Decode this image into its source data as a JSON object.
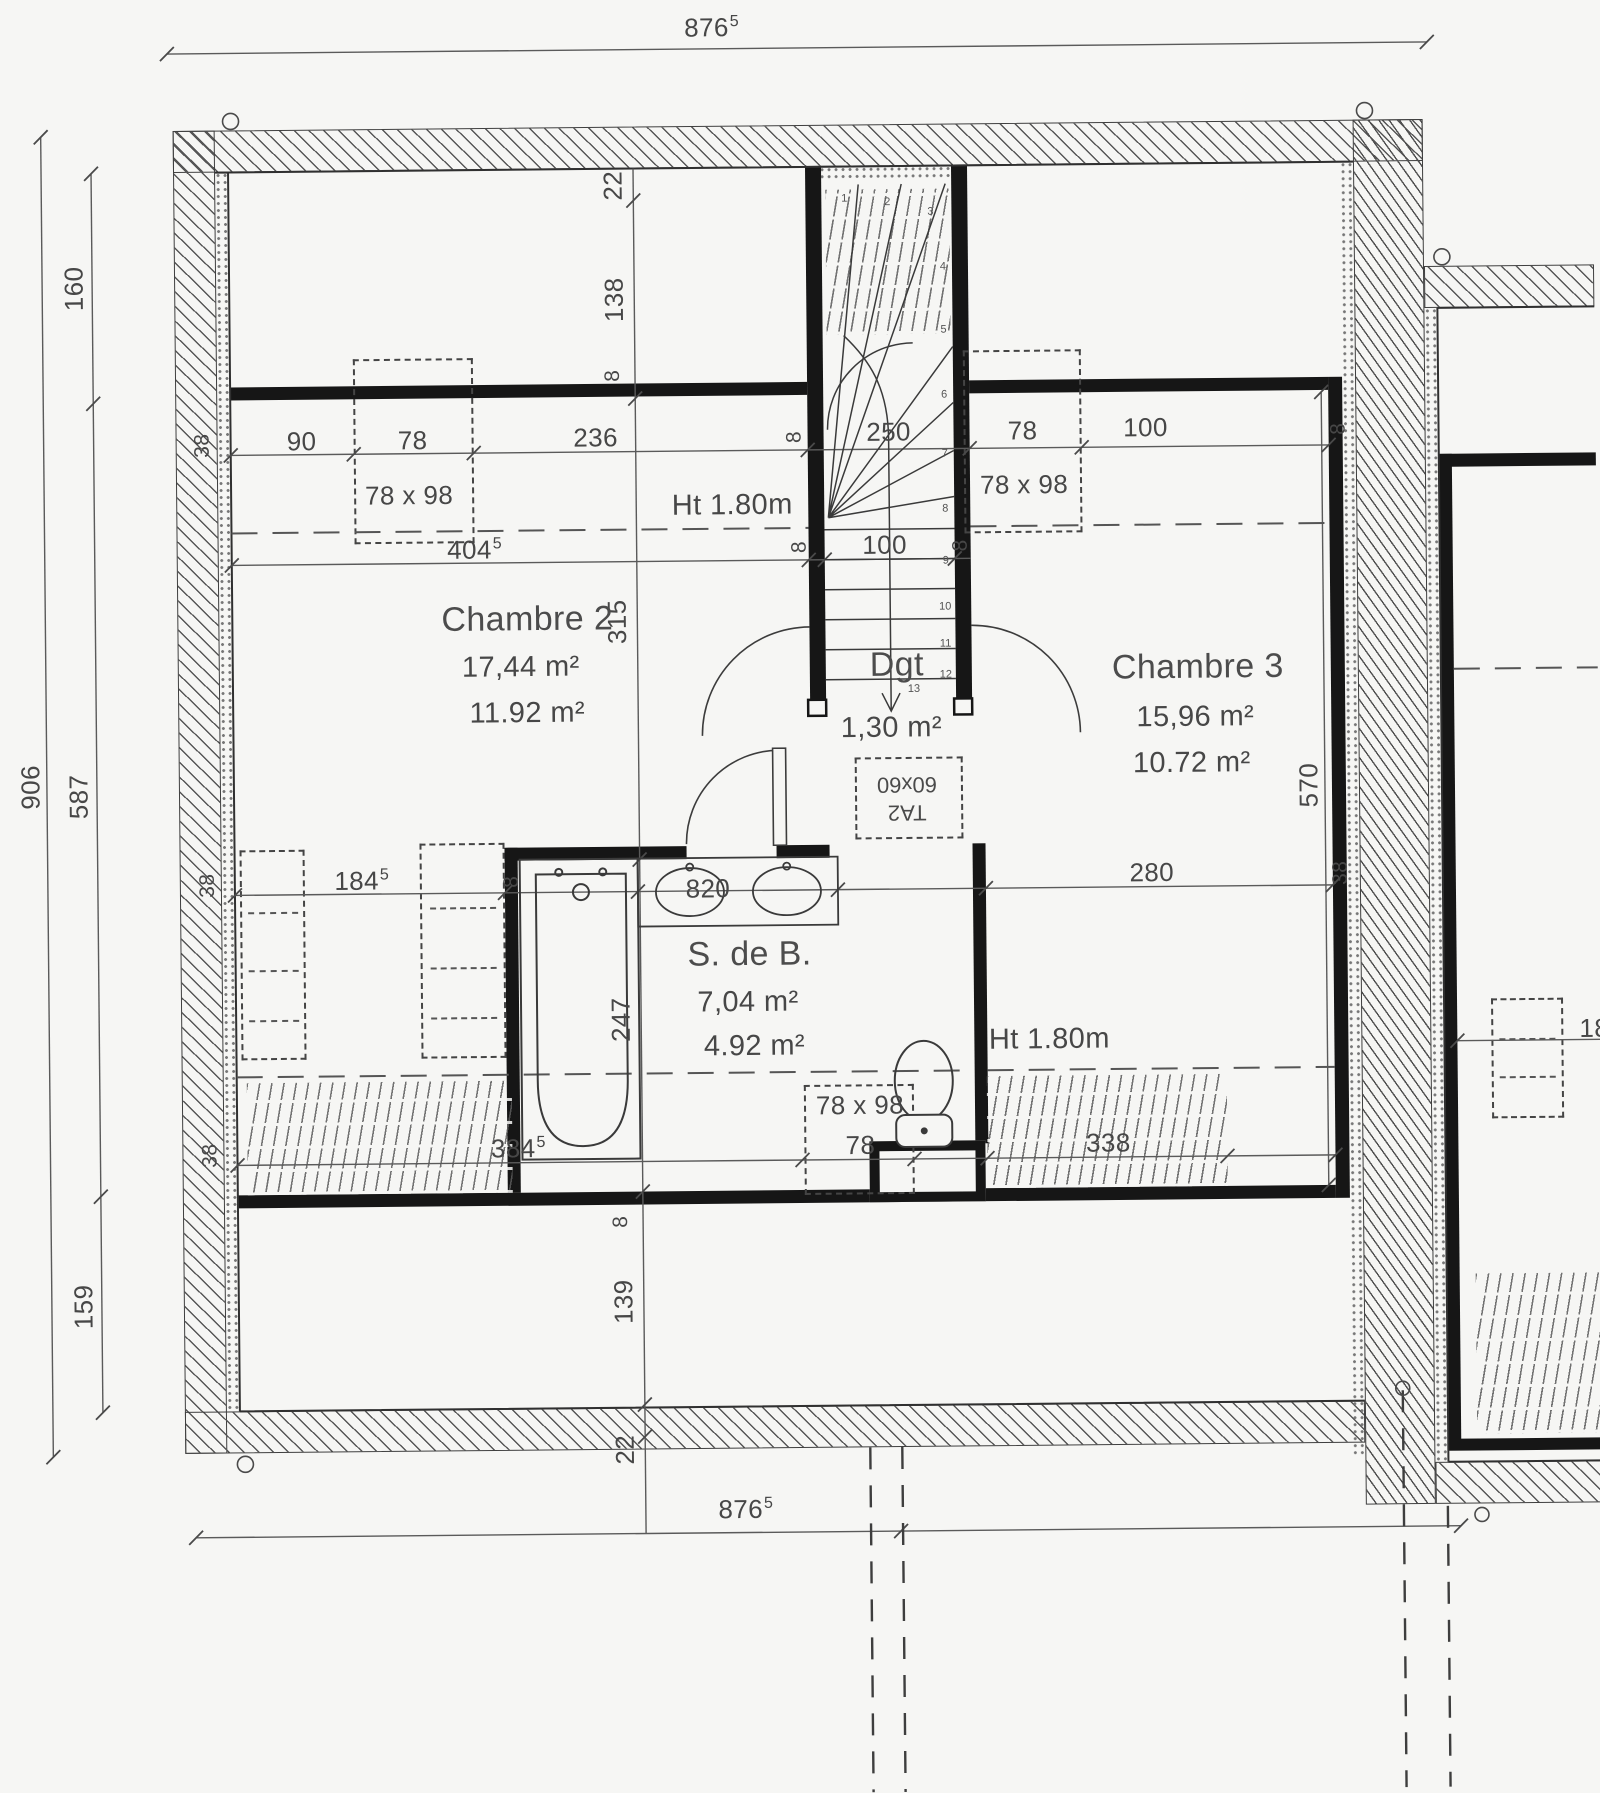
{
  "document": {
    "type": "scanned floor plan (attic storey)",
    "background": "#f6f6f4",
    "line_color": "#3f3f3f",
    "wall_color": "#161616"
  },
  "rooms": {
    "chambre2": {
      "name": "Chambre 2",
      "area": "17,44 m²",
      "area_reduced": "11.92 m²"
    },
    "chambre3": {
      "name": "Chambre 3",
      "area": "15,96 m²",
      "area_reduced": "10.72 m²"
    },
    "degagement": {
      "name": "Dgt",
      "area": "1,30 m²"
    },
    "salle_de_bains": {
      "name": "S. de B.",
      "area": "7,04 m²",
      "area_reduced": "4.92 m²"
    }
  },
  "annotations": {
    "height_line": "Ht 1.80m",
    "hatch_label_line1": "TA2",
    "hatch_label_line2": "60x60",
    "window_size": "78 x 98"
  },
  "dims": {
    "overall_w": "876",
    "overall_w_sup": "5",
    "overall_h": "906",
    "left_160": "160",
    "left_587": "587",
    "left_159": "159",
    "col_22": "22",
    "col_138": "138",
    "col_315": "315",
    "col_247": "247",
    "col_139": "139",
    "w8": "8",
    "w38": "38",
    "r1_90": "90",
    "r1_78": "78",
    "r1_236": "236",
    "r1_250": "250",
    "r1_100": "100",
    "r2_404": "404",
    "r2_404_sup": "5",
    "r3_184": "184",
    "r3_184_sup": "5",
    "r3_820": "820",
    "r3_280": "280",
    "r4_384": "384",
    "r4_384_sup": "5",
    "r4_338": "338",
    "col_570": "570",
    "adjacent_18": "18"
  },
  "stairs": {
    "steps": [
      "1",
      "2",
      "3",
      "4",
      "5",
      "6",
      "7",
      "8",
      "9",
      "10",
      "11",
      "12",
      "13"
    ]
  }
}
